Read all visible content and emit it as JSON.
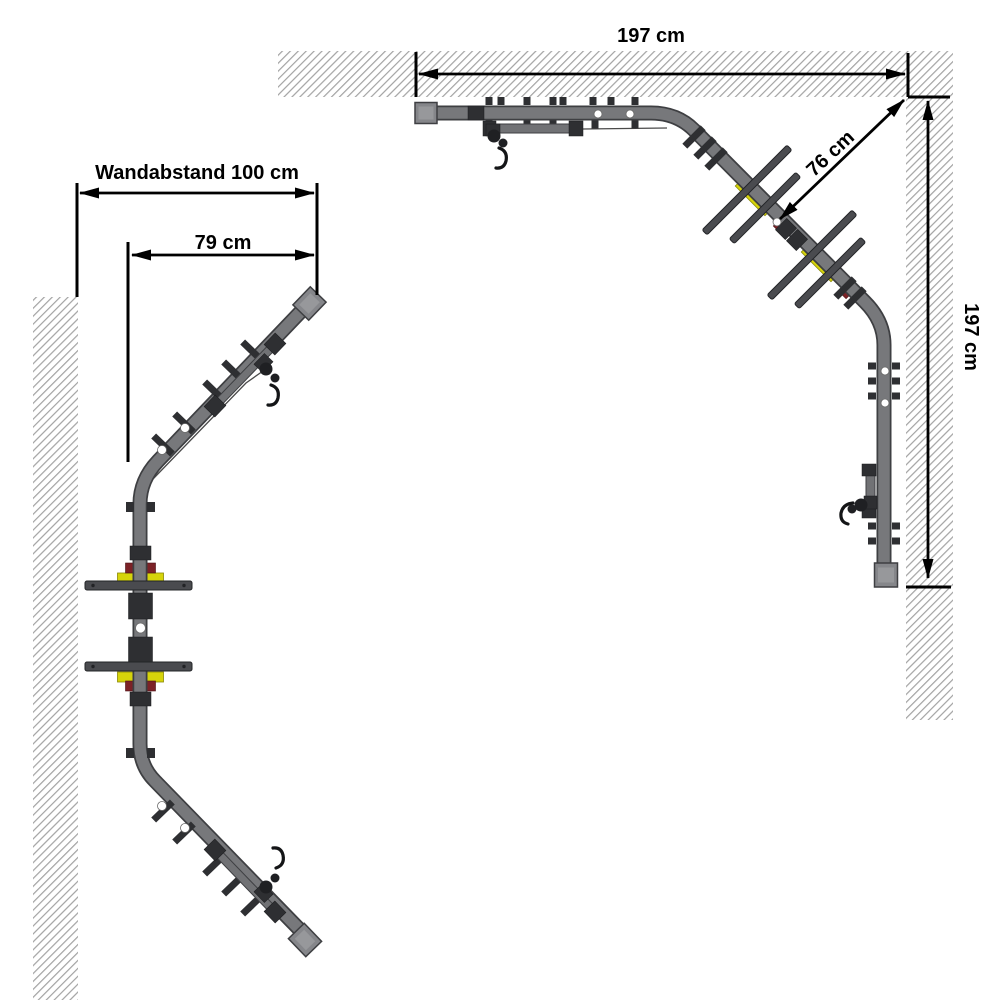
{
  "figures": {
    "straight_wall": {
      "wall_distance_label": "Wandabstand 100 cm",
      "offset_label": "79 cm"
    },
    "corner": {
      "width_label": "197 cm",
      "diagonal_label": "76 cm",
      "height_label": "197 cm"
    }
  },
  "colors": {
    "background": "#ffffff",
    "dimension_lines": "#000000",
    "wall_hatch": "#a3a3a3",
    "tube_gray": "#77787b",
    "tube_outline": "#3e3f42",
    "clamp_dark": "#2e2f32",
    "pad_yellow": "#d6d40a",
    "accent_red": "#7c2227"
  }
}
